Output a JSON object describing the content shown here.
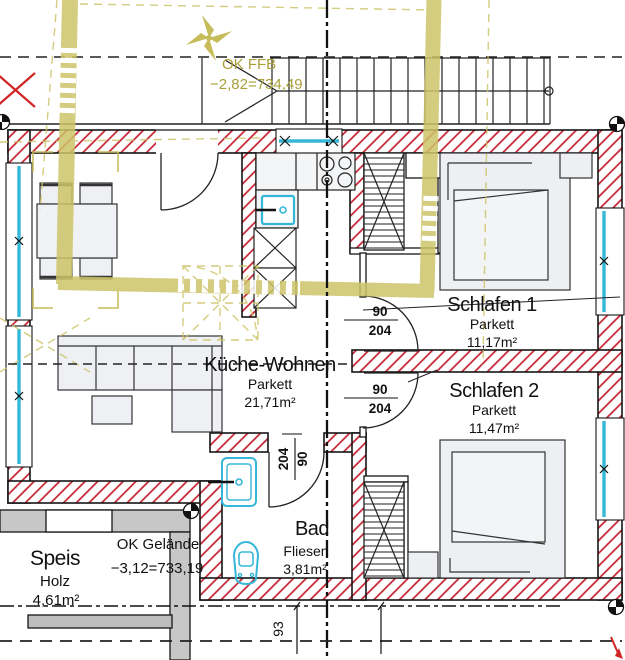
{
  "drawing": {
    "type": "architectural-floor-plan",
    "rooms": {
      "kueche_wohnen": {
        "name": "Küche-Wohnen",
        "floor": "Parkett",
        "area": "21,71m²"
      },
      "schlafen1": {
        "name": "Schlafen 1",
        "floor": "Parkett",
        "area": "11,17m²"
      },
      "schlafen2": {
        "name": "Schlafen 2",
        "floor": "Parkett",
        "area": "11,47m²"
      },
      "bad": {
        "name": "Bad",
        "floor": "Fliesen",
        "area": "3,81m²"
      },
      "speis": {
        "name": "Speis",
        "floor": "Holz",
        "area": "4,61m²"
      }
    },
    "levels": {
      "ok_ffb": {
        "label": "OK FFB",
        "value": "−2,82=734,49"
      },
      "ok_gelaende": {
        "label": "OK Gelände",
        "value": "−3,12=733,19"
      }
    },
    "doors": {
      "width": "90",
      "height": "204"
    },
    "dimensions": {
      "bottom": "93"
    },
    "icons": [
      "north-star-icon",
      "survey-marker-icon",
      "sink-icon",
      "stove-icon",
      "washbasin-icon",
      "toilet-icon"
    ],
    "colors": {
      "wall_hatch": "#c3202f",
      "demolition_olive": "#cdc468",
      "fixture_cyan": "#35b7d8",
      "existing_gray": "#c7c7c7"
    }
  }
}
